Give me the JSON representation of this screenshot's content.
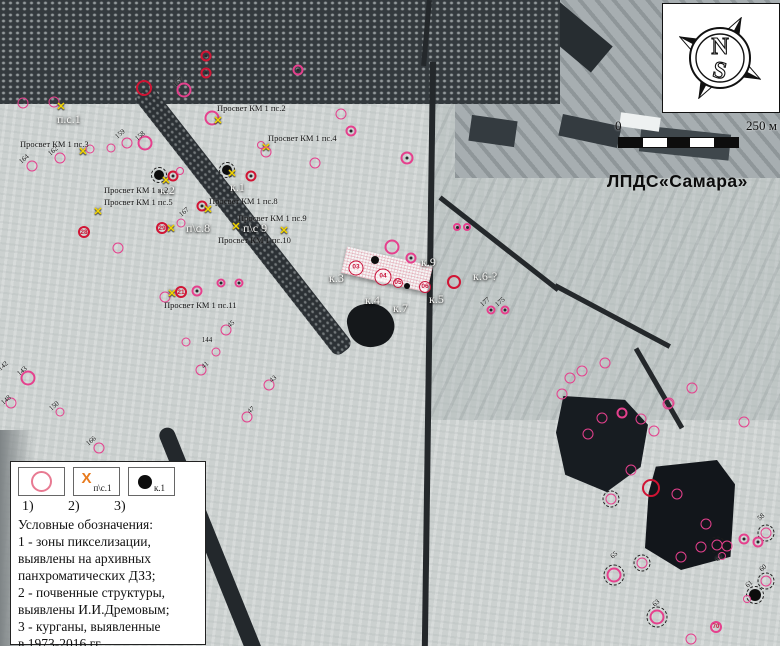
{
  "site_label": "ЛПДС«Самара»",
  "compass": {
    "north": "N",
    "south": "S"
  },
  "scalebar": {
    "zero": "0",
    "max": "250 м"
  },
  "colors": {
    "pink": "#e5408d",
    "red": "#d11434",
    "yellow_x": "#f2d400",
    "legend_orange_x": "#e87b1e"
  },
  "glyphs": {
    "x_marker": "✕",
    "legend_x": "X"
  },
  "legend": {
    "numbers": [
      "1)",
      "2)",
      "3)"
    ],
    "symbols": [
      {
        "name": "pixelation-zone-circle",
        "label": ""
      },
      {
        "name": "soil-structure-x",
        "label": "п\\с.1"
      },
      {
        "name": "kurgan-dot",
        "label": "к.1"
      }
    ],
    "title": "Условные обозначения:",
    "lines": [
      "1 - зоны пикселизации,",
      "выявлены на архивных",
      "панхроматических ДЗЗ;",
      "2 - почвенные структуры,",
      "выявлены И.И.Дремовым;",
      "3 - курганы, выявленные",
      "в 1973-2016 гг."
    ]
  },
  "map": {
    "labels": [
      {
        "t": "Просвет КМ 1 пс.2",
        "x": 217,
        "y": 103,
        "c": "b"
      },
      {
        "t": "Просвет КМ 1 пс.4",
        "x": 268,
        "y": 133,
        "c": "b"
      },
      {
        "t": "Просвет КМ 1 пс.3",
        "x": 20,
        "y": 139,
        "c": "b"
      },
      {
        "t": "Просвет КМ 1 к.2",
        "x": 104,
        "y": 185,
        "c": "b"
      },
      {
        "t": "Просвет КМ 1 пс.5",
        "x": 104,
        "y": 197,
        "c": "b"
      },
      {
        "t": "Просвет КМ 1 пс.8",
        "x": 209,
        "y": 196,
        "c": "b"
      },
      {
        "t": "Просвет КМ 1 пс.9",
        "x": 238,
        "y": 213,
        "c": "b"
      },
      {
        "t": "Просвет КМ 1 пс.10",
        "x": 218,
        "y": 235,
        "c": "b"
      },
      {
        "t": "Просвет КМ 1 пс.11",
        "x": 164,
        "y": 300,
        "c": "b"
      },
      {
        "t": "п.с.1",
        "x": 57,
        "y": 112,
        "c": "w"
      },
      {
        "t": "к.2",
        "x": 160,
        "y": 183,
        "c": "w"
      },
      {
        "t": "к.1",
        "x": 230,
        "y": 180,
        "c": "w"
      },
      {
        "t": "п\\с.8",
        "x": 186,
        "y": 221,
        "c": "w"
      },
      {
        "t": "п\\с 9",
        "x": 243,
        "y": 221,
        "c": "w"
      },
      {
        "t": "к.3",
        "x": 329,
        "y": 271,
        "c": "w"
      },
      {
        "t": "к.4",
        "x": 365,
        "y": 293,
        "c": "w"
      },
      {
        "t": "к.7",
        "x": 393,
        "y": 301,
        "c": "w"
      },
      {
        "t": "к.5",
        "x": 429,
        "y": 292,
        "c": "w"
      },
      {
        "t": "к.9",
        "x": 421,
        "y": 255,
        "c": "w"
      },
      {
        "t": "к.6-?",
        "x": 473,
        "y": 269,
        "c": "w"
      }
    ],
    "nums": [
      {
        "t": "157",
        "x": 178,
        "y": 82
      },
      {
        "t": "159",
        "x": 120,
        "y": 134
      },
      {
        "t": "158",
        "x": 140,
        "y": 136
      },
      {
        "t": "162",
        "x": 53,
        "y": 151
      },
      {
        "t": "164",
        "x": 24,
        "y": 159
      },
      {
        "t": "167",
        "x": 184,
        "y": 212
      },
      {
        "t": "144",
        "x": 207,
        "y": 340,
        "r": 0
      },
      {
        "t": "45",
        "x": 231,
        "y": 324
      },
      {
        "t": "41",
        "x": 205,
        "y": 365
      },
      {
        "t": "43",
        "x": 273,
        "y": 379
      },
      {
        "t": "47",
        "x": 251,
        "y": 410
      },
      {
        "t": "143",
        "x": 22,
        "y": 371
      },
      {
        "t": "142",
        "x": 3,
        "y": 366
      },
      {
        "t": "148",
        "x": 6,
        "y": 400
      },
      {
        "t": "150",
        "x": 54,
        "y": 406
      },
      {
        "t": "166",
        "x": 91,
        "y": 441
      },
      {
        "t": "177",
        "x": 485,
        "y": 302
      },
      {
        "t": "175",
        "x": 500,
        "y": 302
      },
      {
        "t": "58",
        "x": 761,
        "y": 517
      },
      {
        "t": "60",
        "x": 763,
        "y": 568
      },
      {
        "t": "61",
        "x": 749,
        "y": 584
      },
      {
        "t": "62",
        "x": 719,
        "y": 558
      },
      {
        "t": "63",
        "x": 656,
        "y": 603
      },
      {
        "t": "65",
        "x": 614,
        "y": 555
      }
    ],
    "markers": [
      {
        "x": 23,
        "y": 103,
        "t": "p"
      },
      {
        "x": 54,
        "y": 102,
        "t": "p"
      },
      {
        "x": 61,
        "y": 107,
        "t": "x"
      },
      {
        "x": 144,
        "y": 88,
        "t": "r"
      },
      {
        "x": 184,
        "y": 90,
        "t": "P"
      },
      {
        "x": 206,
        "y": 56,
        "t": "rd"
      },
      {
        "x": 206,
        "y": 73,
        "t": "rd"
      },
      {
        "x": 298,
        "y": 70,
        "t": "pd"
      },
      {
        "x": 212,
        "y": 118,
        "t": "P"
      },
      {
        "x": 218,
        "y": 121,
        "t": "x"
      },
      {
        "x": 261,
        "y": 145,
        "t": "p",
        "d": 8
      },
      {
        "x": 266,
        "y": 148,
        "t": "x"
      },
      {
        "x": 127,
        "y": 143,
        "t": "p"
      },
      {
        "x": 145,
        "y": 143,
        "t": "P"
      },
      {
        "x": 111,
        "y": 148,
        "t": "p",
        "d": 9
      },
      {
        "x": 83,
        "y": 152,
        "t": "x"
      },
      {
        "x": 90,
        "y": 149,
        "t": "p",
        "d": 9
      },
      {
        "x": 60,
        "y": 158,
        "t": "p"
      },
      {
        "x": 32,
        "y": 166,
        "t": "p"
      },
      {
        "x": 159,
        "y": 175,
        "t": "b",
        "ring": 1
      },
      {
        "x": 166,
        "y": 181,
        "t": "x"
      },
      {
        "x": 173,
        "y": 176,
        "t": "rd"
      },
      {
        "x": 180,
        "y": 171,
        "t": "p",
        "d": 8
      },
      {
        "x": 227,
        "y": 170,
        "t": "b",
        "ring": 1
      },
      {
        "x": 232,
        "y": 174,
        "t": "x"
      },
      {
        "x": 251,
        "y": 176,
        "t": "rd"
      },
      {
        "x": 266,
        "y": 152,
        "t": "p"
      },
      {
        "x": 315,
        "y": 163,
        "t": "p"
      },
      {
        "x": 202,
        "y": 206,
        "t": "rd"
      },
      {
        "x": 208,
        "y": 210,
        "t": "x"
      },
      {
        "x": 236,
        "y": 227,
        "t": "x"
      },
      {
        "x": 284,
        "y": 231,
        "t": "x"
      },
      {
        "x": 162,
        "y": 228,
        "t": "rs",
        "num": "29"
      },
      {
        "x": 171,
        "y": 229,
        "t": "x"
      },
      {
        "x": 181,
        "y": 223,
        "t": "p",
        "d": 9
      },
      {
        "x": 98,
        "y": 212,
        "t": "x"
      },
      {
        "x": 84,
        "y": 232,
        "t": "rs",
        "num": "28"
      },
      {
        "x": 118,
        "y": 248,
        "t": "p"
      },
      {
        "x": 165,
        "y": 297,
        "t": "p"
      },
      {
        "x": 172,
        "y": 294,
        "t": "x"
      },
      {
        "x": 181,
        "y": 292,
        "t": "rs",
        "num": "21"
      },
      {
        "x": 197,
        "y": 291,
        "t": "pd"
      },
      {
        "x": 221,
        "y": 283,
        "t": "pd",
        "d": 9
      },
      {
        "x": 239,
        "y": 283,
        "t": "pd",
        "d": 9
      },
      {
        "x": 226,
        "y": 330,
        "t": "p"
      },
      {
        "x": 216,
        "y": 352,
        "t": "p",
        "d": 9
      },
      {
        "x": 201,
        "y": 370,
        "t": "p"
      },
      {
        "x": 269,
        "y": 385,
        "t": "p"
      },
      {
        "x": 247,
        "y": 417,
        "t": "p"
      },
      {
        "x": 186,
        "y": 342,
        "t": "p",
        "d": 9
      },
      {
        "x": 28,
        "y": 378,
        "t": "P"
      },
      {
        "x": 11,
        "y": 403,
        "t": "p"
      },
      {
        "x": 60,
        "y": 412,
        "t": "p",
        "d": 9
      },
      {
        "x": 99,
        "y": 448,
        "t": "p"
      },
      {
        "x": 356,
        "y": 268,
        "t": "bn",
        "num": "03",
        "d": 15
      },
      {
        "x": 383,
        "y": 277,
        "t": "bn",
        "num": "04",
        "d": 17
      },
      {
        "x": 398,
        "y": 283,
        "t": "bn",
        "num": "05",
        "d": 10
      },
      {
        "x": 407,
        "y": 286,
        "t": "b",
        "d": 6
      },
      {
        "x": 425,
        "y": 287,
        "t": "bn",
        "num": "06",
        "d": 12
      },
      {
        "x": 375,
        "y": 260,
        "t": "b",
        "d": 8
      },
      {
        "x": 392,
        "y": 247,
        "t": "P"
      },
      {
        "x": 411,
        "y": 258,
        "t": "pd"
      },
      {
        "x": 454,
        "y": 282,
        "t": "r",
        "d": 14
      },
      {
        "x": 491,
        "y": 310,
        "t": "pd",
        "d": 9
      },
      {
        "x": 505,
        "y": 310,
        "t": "pd",
        "d": 9
      },
      {
        "x": 341,
        "y": 114,
        "t": "p"
      },
      {
        "x": 351,
        "y": 131,
        "t": "pd"
      },
      {
        "x": 407,
        "y": 158,
        "t": "pd",
        "d": 13
      },
      {
        "x": 457,
        "y": 227,
        "t": "pd",
        "d": 8
      },
      {
        "x": 467,
        "y": 227,
        "t": "pd",
        "d": 8
      },
      {
        "x": 570,
        "y": 378,
        "t": "p"
      },
      {
        "x": 582,
        "y": 371,
        "t": "p"
      },
      {
        "x": 605,
        "y": 363,
        "t": "p"
      },
      {
        "x": 562,
        "y": 394,
        "t": "p"
      },
      {
        "x": 692,
        "y": 388,
        "t": "p"
      },
      {
        "x": 668,
        "y": 404,
        "t": "p"
      },
      {
        "x": 602,
        "y": 418,
        "t": "p"
      },
      {
        "x": 588,
        "y": 434,
        "t": "p"
      },
      {
        "x": 622,
        "y": 413,
        "t": "pd"
      },
      {
        "x": 641,
        "y": 419,
        "t": "p"
      },
      {
        "x": 654,
        "y": 431,
        "t": "p"
      },
      {
        "x": 669,
        "y": 403,
        "t": "p"
      },
      {
        "x": 744,
        "y": 422,
        "t": "p"
      },
      {
        "x": 631,
        "y": 470,
        "t": "p"
      },
      {
        "x": 651,
        "y": 488,
        "t": "r",
        "d": 18
      },
      {
        "x": 677,
        "y": 494,
        "t": "p"
      },
      {
        "x": 611,
        "y": 499,
        "t": "p",
        "ring": 1
      },
      {
        "x": 706,
        "y": 524,
        "t": "p"
      },
      {
        "x": 701,
        "y": 547,
        "t": "p"
      },
      {
        "x": 681,
        "y": 557,
        "t": "p"
      },
      {
        "x": 717,
        "y": 545,
        "t": "p",
        "ring": 1
      },
      {
        "x": 766,
        "y": 533,
        "t": "p",
        "ring": 1
      },
      {
        "x": 744,
        "y": 539,
        "t": "pd"
      },
      {
        "x": 758,
        "y": 542,
        "t": "pd"
      },
      {
        "x": 727,
        "y": 546,
        "t": "p"
      },
      {
        "x": 642,
        "y": 563,
        "t": "p",
        "ring": 1
      },
      {
        "x": 614,
        "y": 575,
        "t": "P",
        "ring": 1
      },
      {
        "x": 722,
        "y": 556,
        "t": "p",
        "d": 8
      },
      {
        "x": 766,
        "y": 581,
        "t": "p",
        "ring": 1
      },
      {
        "x": 755,
        "y": 595,
        "t": "b",
        "d": 12,
        "ring": 1
      },
      {
        "x": 747,
        "y": 599,
        "t": "p",
        "d": 8
      },
      {
        "x": 657,
        "y": 617,
        "t": "P",
        "ring": 1
      },
      {
        "x": 716,
        "y": 627,
        "t": "pn",
        "num": "70",
        "d": 12
      },
      {
        "x": 691,
        "y": 639,
        "t": "p"
      }
    ]
  }
}
